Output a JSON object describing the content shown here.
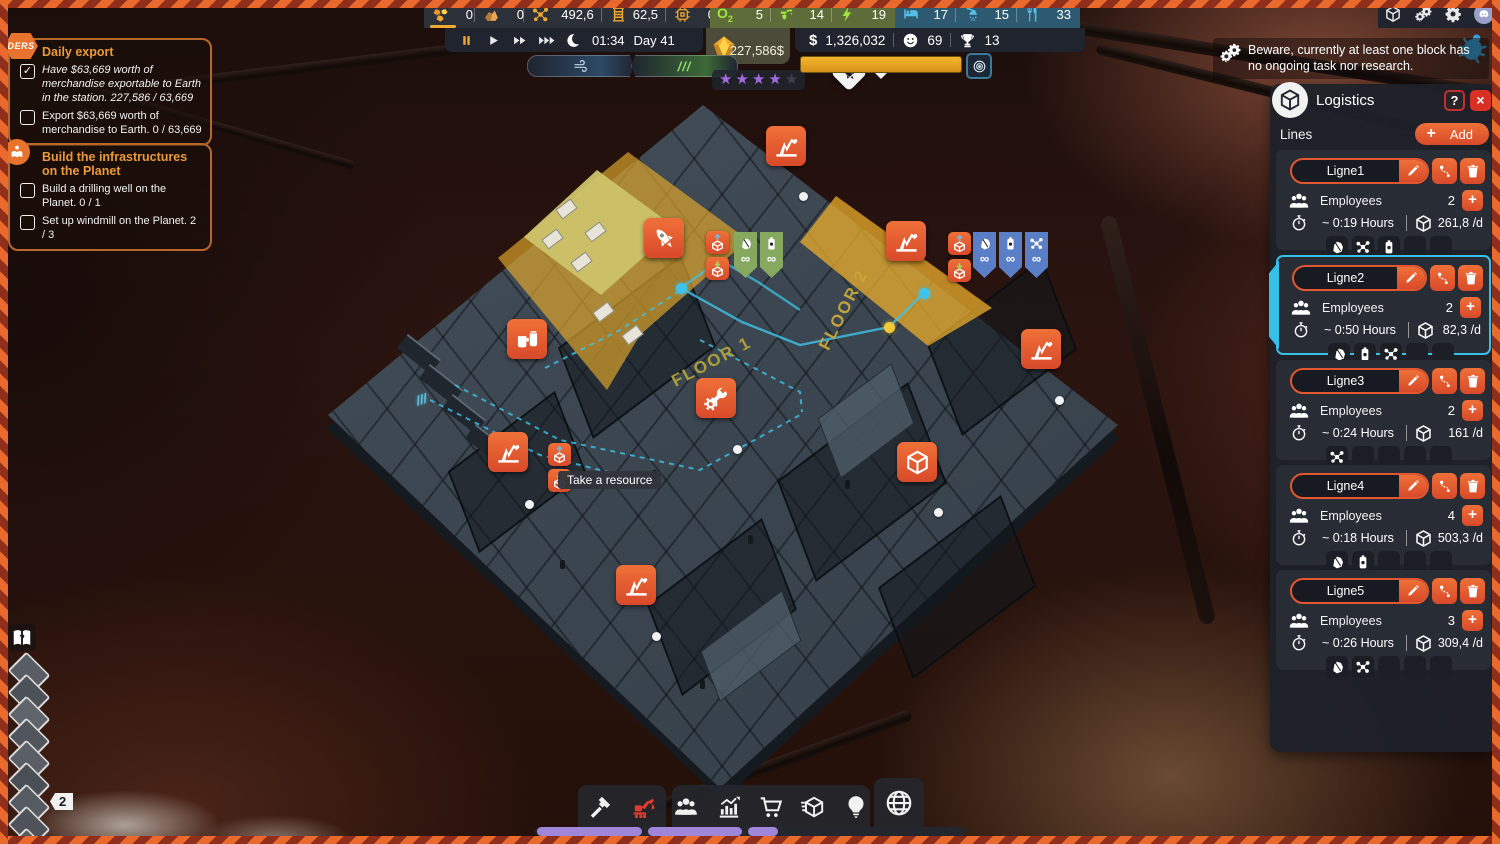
{
  "top_bar": {
    "resources": [
      {
        "icon": "gold-ore",
        "value": "0",
        "selected": true
      },
      {
        "icon": "rock",
        "value": "0"
      },
      {
        "icon": "molecule-gold",
        "value": "492,6"
      },
      {
        "icon": "wire-coil",
        "value": "62,5"
      },
      {
        "icon": "chip",
        "value": "0"
      }
    ],
    "life_support": [
      {
        "icon": "oxygen",
        "value": "5"
      },
      {
        "icon": "water-tap",
        "value": "14"
      },
      {
        "icon": "power-bolt",
        "value": "19"
      }
    ],
    "comfort": [
      {
        "icon": "bed",
        "value": "17"
      },
      {
        "icon": "shower",
        "value": "15"
      },
      {
        "icon": "food",
        "value": "33"
      }
    ]
  },
  "top_right_icons": [
    {
      "icon": "storage-box"
    },
    {
      "icon": "automation-gears"
    },
    {
      "icon": "settings-gear"
    },
    {
      "icon": "discord"
    }
  ],
  "time_bar": {
    "time": "01:34",
    "day": "Day 41"
  },
  "status_bar": {
    "export_value": "227,586$",
    "money": "1,326,032",
    "happiness": "69",
    "trophies": "13",
    "stars_filled": 4,
    "stars_total": 5
  },
  "notification": {
    "text": "Beware, currently at least one block has no ongoing task nor research."
  },
  "quests": [
    {
      "badge": "DERS",
      "badge_shape": "hex",
      "title": "Daily export",
      "tasks": [
        {
          "checked": true,
          "italic": true,
          "text": "Have $63,669 worth of merchandise exportable to Earth in the station.  227,586 / 63,669"
        },
        {
          "checked": false,
          "italic": false,
          "text": "Export $63,669 worth of merchandise to Earth. 0 / 63,669"
        }
      ]
    },
    {
      "badge": "tutorial",
      "badge_shape": "circle",
      "title": "Build the infrastructures on the Planet",
      "tasks": [
        {
          "checked": false,
          "italic": false,
          "text": "Build a drilling well on the Planet. 0 / 1"
        },
        {
          "checked": false,
          "italic": false,
          "text": "Set up windmill on the Planet. 2 / 3"
        }
      ]
    }
  ],
  "logistics": {
    "title": "Logistics",
    "help_label": "?",
    "close_label": "×",
    "lines_label": "Lines",
    "add_label": "Add",
    "employees_label": "Employees",
    "slot_count": 5,
    "accent_color": "#e2572f",
    "selected_color": "#35c0e8",
    "lines": [
      {
        "name": "Ligne1",
        "employees": "2",
        "hours": "~ 0:19 Hours",
        "rate": "261,8 /d",
        "slots": [
          "ore",
          "molecule",
          "battery"
        ],
        "selected": false
      },
      {
        "name": "Ligne2",
        "employees": "2",
        "hours": "~ 0:50 Hours",
        "rate": "82,3 /d",
        "slots": [
          "ore",
          "battery",
          "molecule"
        ],
        "selected": true
      },
      {
        "name": "Ligne3",
        "employees": "2",
        "hours": "~ 0:24 Hours",
        "rate": "161 /d",
        "slots": [
          "molecule"
        ],
        "selected": false
      },
      {
        "name": "Ligne4",
        "employees": "4",
        "hours": "~ 0:18 Hours",
        "rate": "503,3 /d",
        "slots": [
          "ore",
          "battery"
        ],
        "selected": false
      },
      {
        "name": "Ligne5",
        "employees": "3",
        "hours": "~ 0:26 Hours",
        "rate": "309,4 /d",
        "slots": [
          "ore",
          "molecule"
        ],
        "selected": false
      }
    ]
  },
  "toolbar": {
    "build_group": [
      {
        "icon": "hammer",
        "active": false
      },
      {
        "icon": "excavator",
        "active": true
      }
    ],
    "manage_group": [
      {
        "icon": "people",
        "active": false
      },
      {
        "icon": "stats-chart",
        "active": false
      },
      {
        "icon": "shopping-cart",
        "active": false
      },
      {
        "icon": "logistics-box",
        "active": false
      },
      {
        "icon": "idea-bulb",
        "active": false
      }
    ],
    "planet_button": {
      "icon": "globe"
    }
  },
  "map": {
    "floor1_label": "FLOOR 1",
    "floor2_label": "FLOOR 2",
    "tooltip": "Take a resource",
    "level_badge": "2",
    "infinity_symbol": "∞",
    "badges": [
      {
        "icon": "pumpjack",
        "x": 786,
        "y": 146
      },
      {
        "icon": "rocket",
        "x": 664,
        "y": 238
      },
      {
        "icon": "pumpjack",
        "x": 906,
        "y": 241
      },
      {
        "icon": "canteen",
        "x": 527,
        "y": 339
      },
      {
        "icon": "wrench-gear",
        "x": 716,
        "y": 398
      },
      {
        "icon": "pumpjack",
        "x": 508,
        "y": 452
      },
      {
        "icon": "pumpjack",
        "x": 1041,
        "y": 349
      },
      {
        "icon": "storage-box",
        "x": 917,
        "y": 462
      },
      {
        "icon": "pumpjack",
        "x": 636,
        "y": 585
      }
    ],
    "poi_badge": {
      "icon": "rocket",
      "x": 849,
      "y": 73
    },
    "chips": [
      {
        "icon": "ore",
        "variant": "green",
        "x": 734,
        "y": 232
      },
      {
        "icon": "battery",
        "variant": "green",
        "x": 760,
        "y": 232
      },
      {
        "icon": "ore",
        "variant": "blue",
        "x": 973,
        "y": 232
      },
      {
        "icon": "battery",
        "variant": "blue",
        "x": 999,
        "y": 232
      },
      {
        "icon": "molecule",
        "variant": "blue",
        "x": 1025,
        "y": 232
      }
    ],
    "miniboxes": [
      {
        "icon": "box-export",
        "x": 706,
        "y": 231
      },
      {
        "icon": "box-import",
        "x": 706,
        "y": 257
      },
      {
        "icon": "box-export",
        "x": 948,
        "y": 232
      },
      {
        "icon": "box-import",
        "x": 948,
        "y": 259
      },
      {
        "icon": "box-export",
        "x": 548,
        "y": 443
      },
      {
        "icon": "box-import",
        "x": 548,
        "y": 469
      }
    ],
    "dots": [
      {
        "x": 803,
        "y": 196
      },
      {
        "x": 529,
        "y": 504
      },
      {
        "x": 656,
        "y": 636
      },
      {
        "x": 737,
        "y": 449
      },
      {
        "x": 938,
        "y": 512
      },
      {
        "x": 1059,
        "y": 400
      }
    ],
    "route_dots": [
      {
        "x": 681,
        "y": 288,
        "color": "cyan"
      },
      {
        "x": 924,
        "y": 293,
        "color": "cyan"
      },
      {
        "x": 889,
        "y": 327,
        "color": "yellow"
      }
    ]
  }
}
